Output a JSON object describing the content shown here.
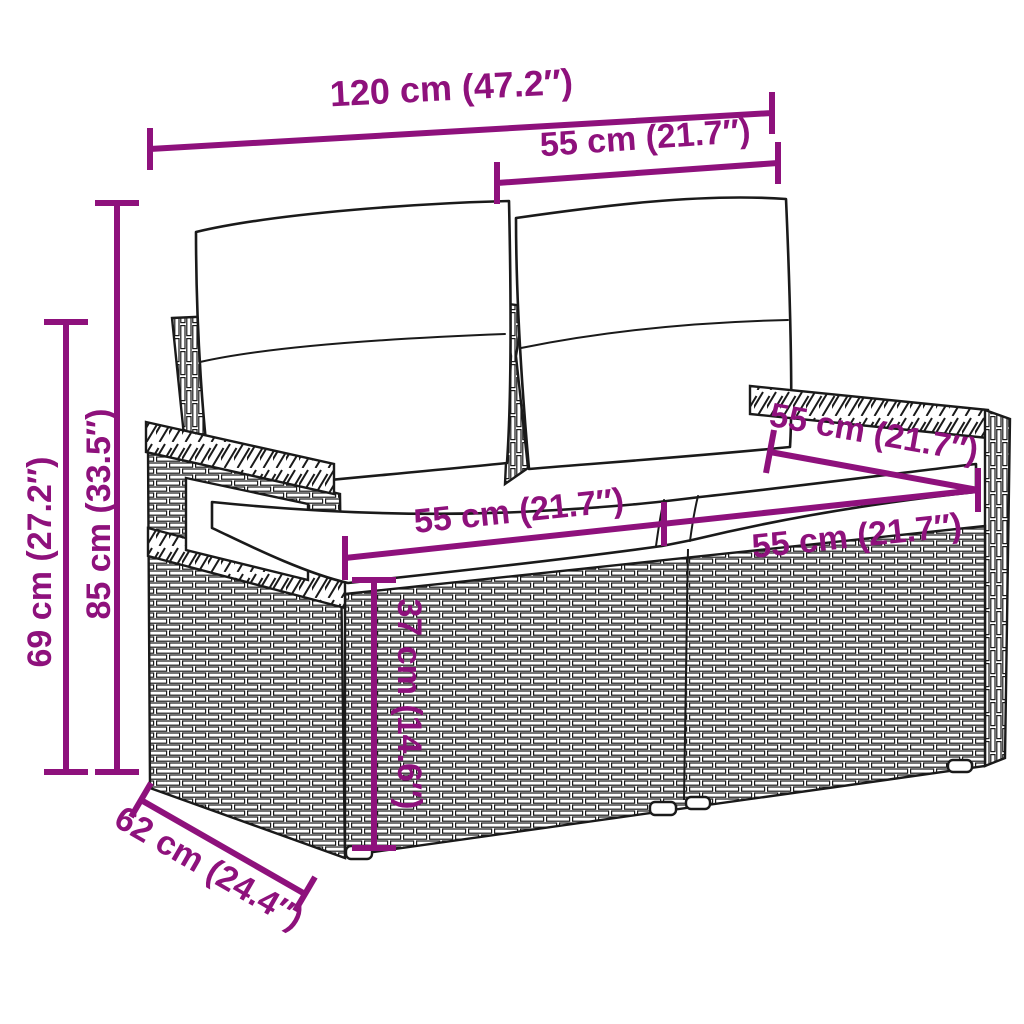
{
  "colors": {
    "dimension": "#8E117C",
    "line_art": "#1A1A1A",
    "background": "#FFFFFF"
  },
  "dimensions": {
    "overall_width": {
      "label": "120 cm (47.2″)"
    },
    "back_section_width": {
      "label": "55 cm (21.7″)"
    },
    "overall_height": {
      "label": "85 cm (33.5″)"
    },
    "armrest_height": {
      "label": "69 cm (27.2″)"
    },
    "seat_depth": {
      "label": "55 cm (21.7″)"
    },
    "seat_left_width": {
      "label": "55 cm (21.7″)"
    },
    "seat_right_width": {
      "label": "55 cm (21.7″)"
    },
    "seat_height": {
      "label": "37 cm (14.6″)"
    },
    "overall_depth": {
      "label": "62 cm (24.4″)"
    }
  }
}
